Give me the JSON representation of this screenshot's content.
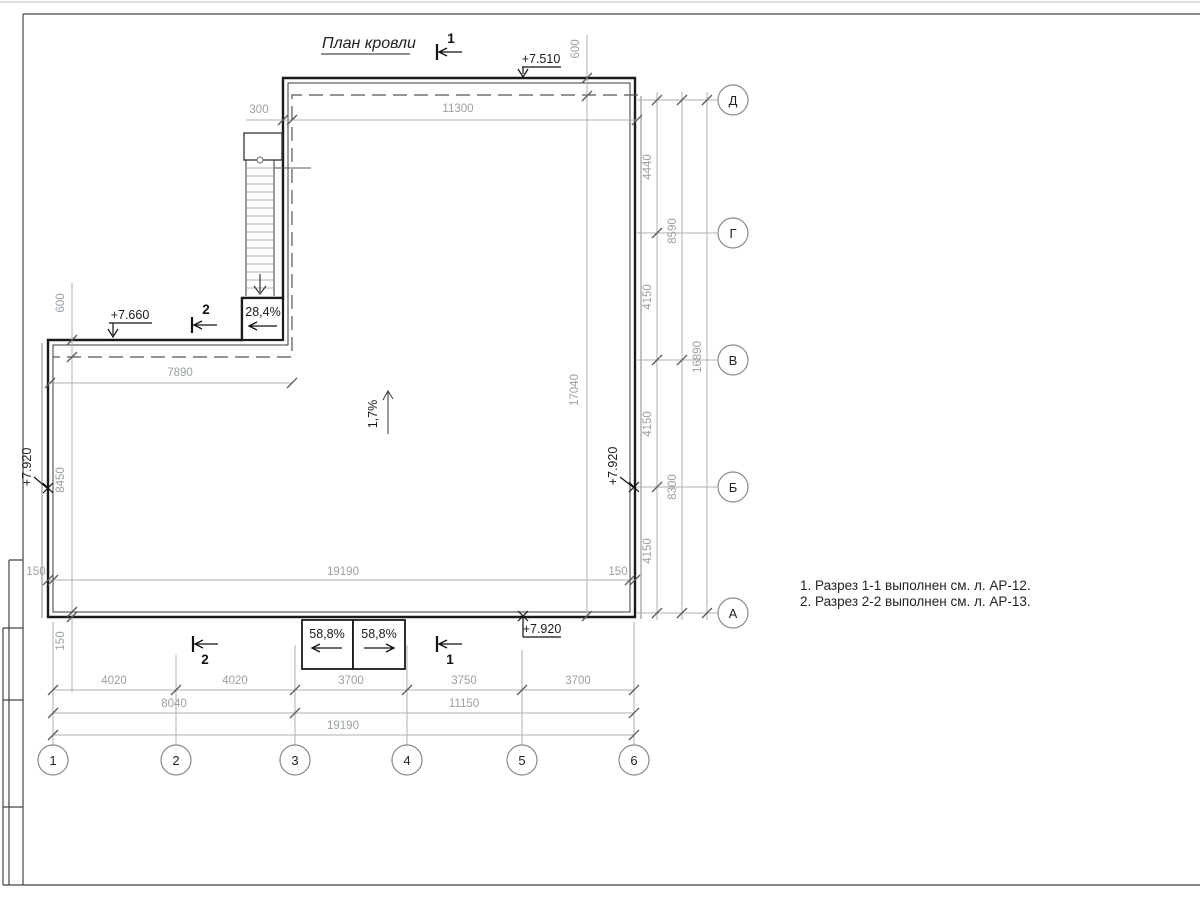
{
  "title": {
    "text": "План кровли"
  },
  "notes": {
    "line1": "1. Разрез 1-1 выполнен см. л. АР-12.",
    "line2": "2. Разрез 2-2 выполнен см. л. АР-13."
  },
  "elevations": {
    "roof_upper": "+7.510",
    "roof_step": "+7.660",
    "roof_left": "+7.920",
    "roof_right": "+7.920",
    "roof_bottom": "+7.920"
  },
  "slopes": {
    "main": "1,7%",
    "ladder": "28,4%",
    "ramp_left": "58,8%",
    "ramp_right": "58,8%"
  },
  "section_marks": {
    "top_1": "1",
    "top_2": "2",
    "bottom_1": "1",
    "bottom_2": "2"
  },
  "axes": {
    "letters": [
      "Д",
      "Г",
      "В",
      "Б",
      "А"
    ],
    "numbers": [
      "1",
      "2",
      "3",
      "4",
      "5",
      "6"
    ]
  },
  "dimensions": {
    "top": {
      "offset": "300",
      "upper_width": "11300",
      "parapet_top": "600"
    },
    "left": {
      "parapet_step": "600",
      "step_width": "7890",
      "south_height": "8450",
      "wall_150_left": "150",
      "wall_150_bottom": "150"
    },
    "inner": {
      "total_width": "19190",
      "east_height": "17040",
      "wall_150_right": "150"
    },
    "right": {
      "col1": [
        "4440",
        "4150",
        "4150",
        "4150"
      ],
      "col2": [
        "8590",
        "8300"
      ],
      "col3": [
        "16890"
      ]
    },
    "bottom": {
      "row1": [
        "4020",
        "4020",
        "3700",
        "3750",
        "3700"
      ],
      "row2": [
        "8040",
        "11150"
      ],
      "row3": [
        "19190"
      ]
    }
  },
  "colors": {
    "ink": "#1a1a1a",
    "dim": "#9aa0a4",
    "frame": "#333333"
  }
}
